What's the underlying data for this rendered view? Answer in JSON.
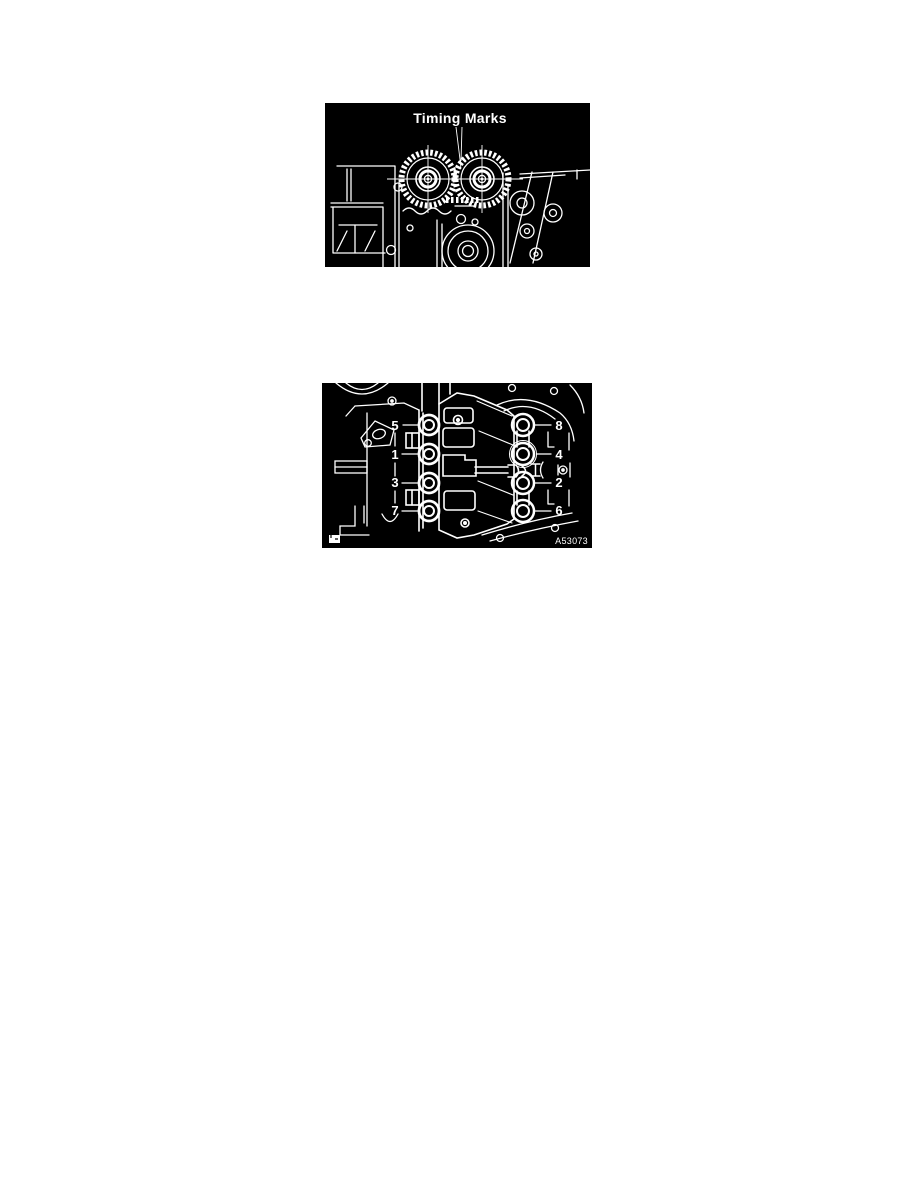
{
  "page": {
    "kind": "service-manual-page",
    "background_color": "#ffffff"
  },
  "figures": {
    "timing": {
      "caption": "Timing Marks",
      "background_color": "#000000",
      "line_color": "#ffffff",
      "description": "Front view of cylinder head with two camshaft timing gears meshed, leader pointing to timing marks at gear mesh"
    },
    "bolt_sequence": {
      "left_labels": [
        "5",
        "1",
        "3",
        "7"
      ],
      "right_labels": [
        "8",
        "4",
        "2",
        "6"
      ],
      "figure_code": "A53073",
      "background_color": "#000000",
      "line_color": "#ffffff",
      "description": "Bearing cap bolt tightening sequence, two columns of four bolts numbered 1 through 8"
    }
  }
}
